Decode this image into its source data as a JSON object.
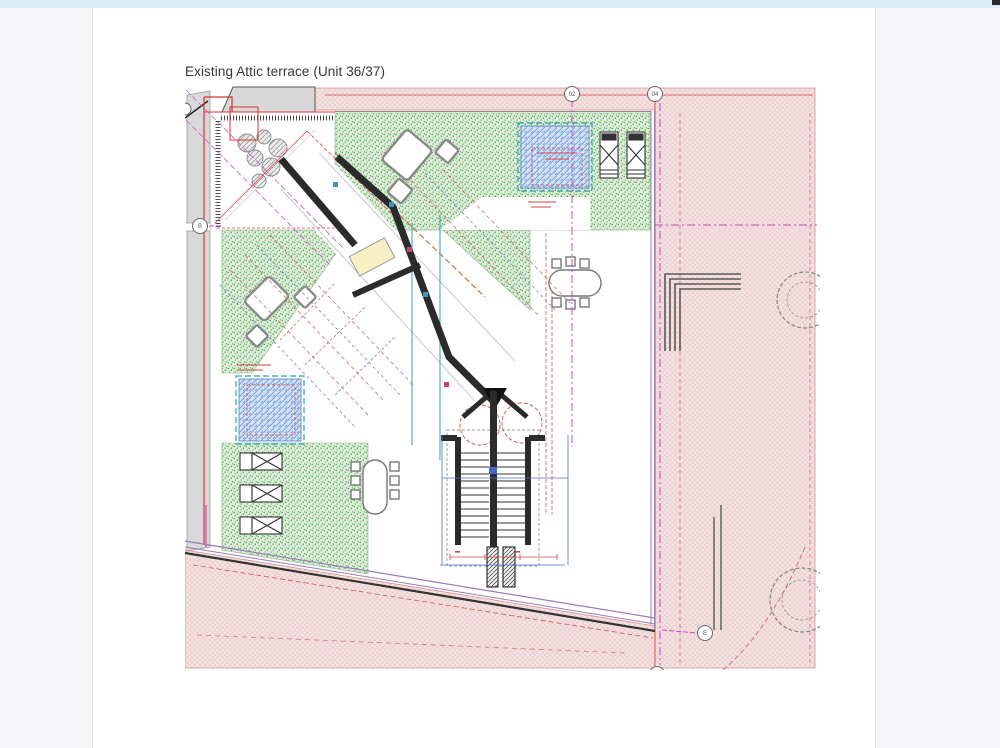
{
  "app": {
    "topbar_color": "#d8ecfa",
    "panel_color": "#f6f6f8"
  },
  "document": {
    "title": "Existing Attic terrace (Unit 36/37)"
  },
  "drawing": {
    "grid_bubbles": {
      "col_left": "02",
      "col_right": "04",
      "row_left": "B",
      "bottom_right": "E"
    },
    "colors": {
      "surround_hatch": "#f3dede",
      "green_roof": "#d8ebd4",
      "skylight_fill": "#d4e2f4",
      "skylight_frame": "#2fa3b4",
      "walls": "#2b2b2b",
      "boundary_red": "#e05050",
      "grid_magenta": "#cc44cc",
      "dimension_blue": "#4f6fd0"
    }
  }
}
